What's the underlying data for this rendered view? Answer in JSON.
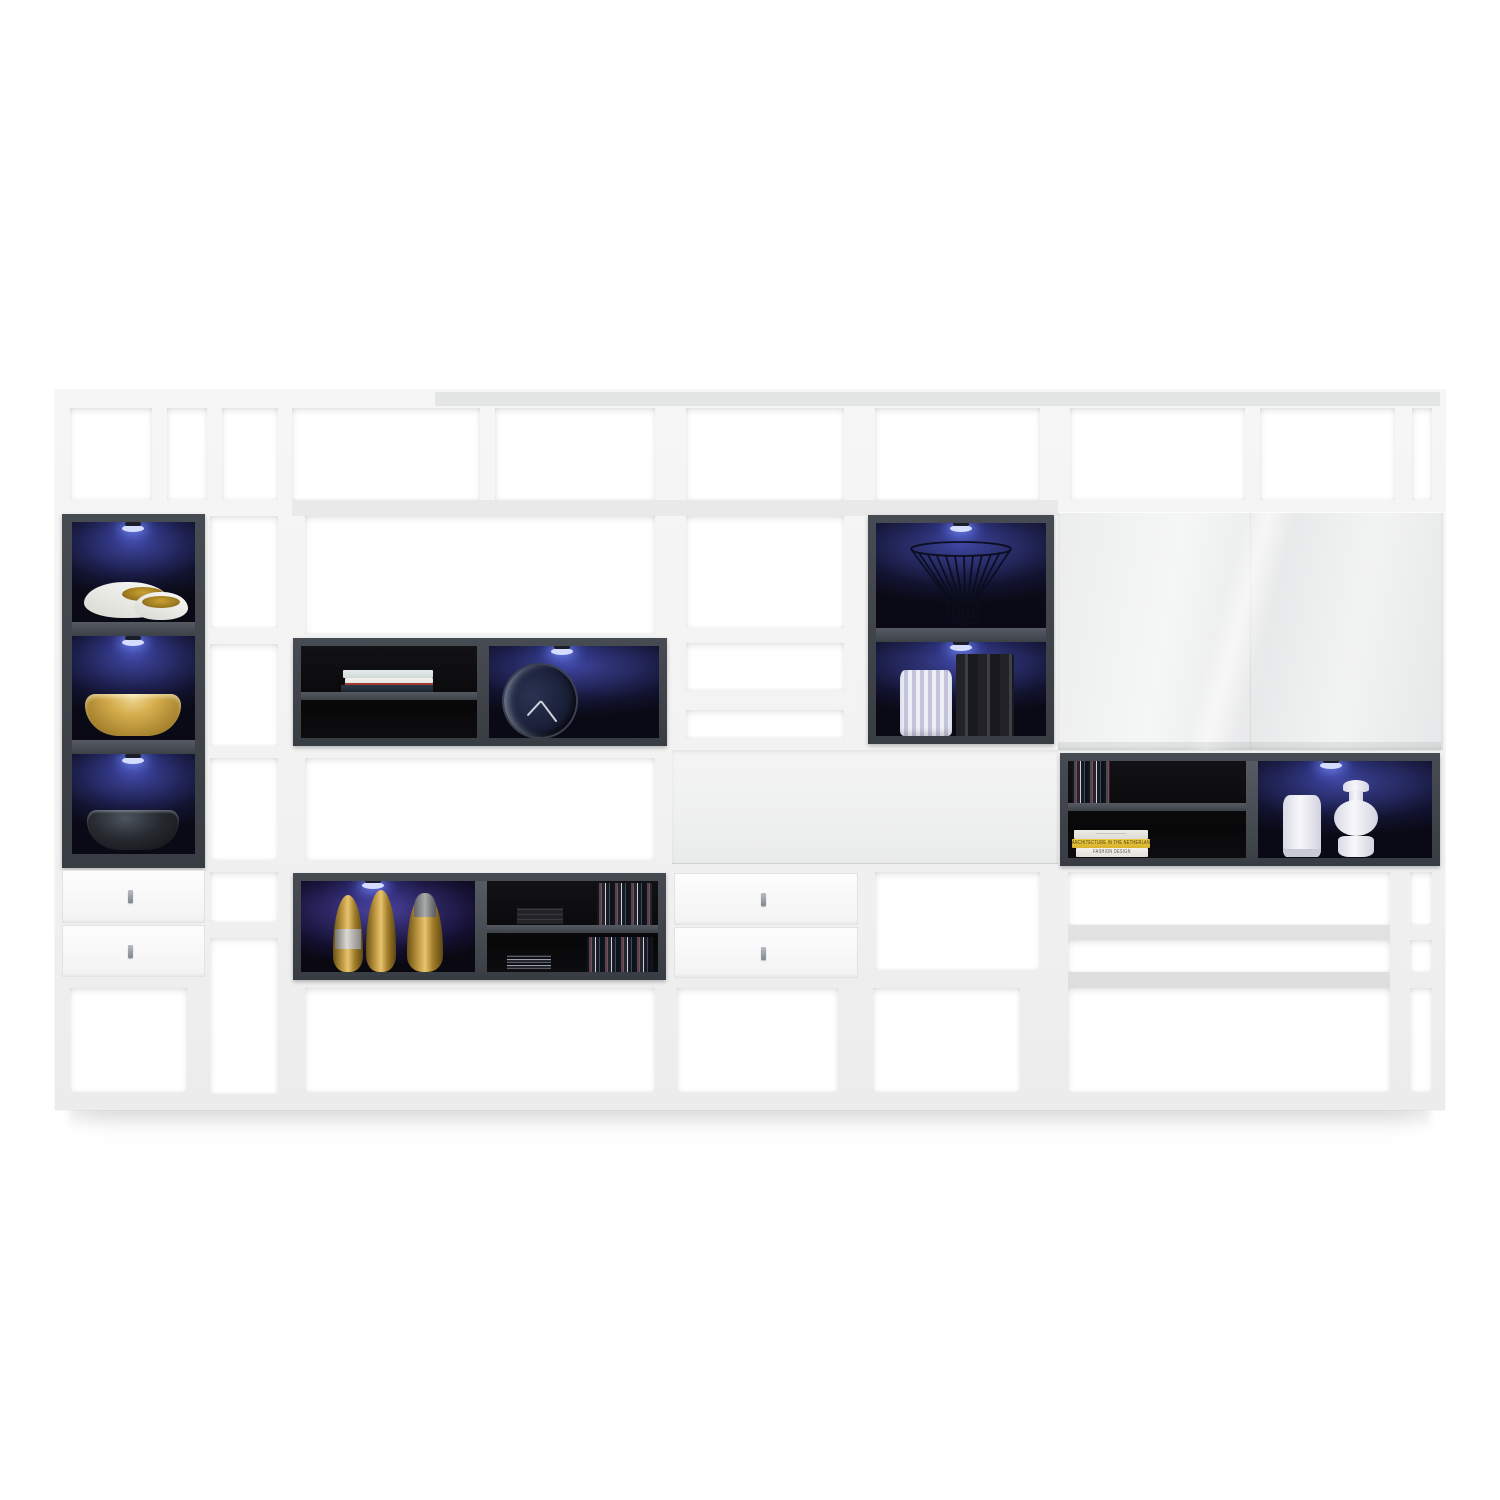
{
  "image": {
    "type": "product-photo",
    "subject": "White high-gloss living-room wall shelving unit with anthracite LED-lit display compartments, drawers and decor",
    "background_color": "#ffffff"
  },
  "palette": {
    "frame_white": "#f2f2f2",
    "open_cell": "#ffffff",
    "anthracite_frame": "#43474e",
    "black_interior": "#0a0a0d",
    "blue_led_glow": "#3c418f",
    "purple_led_glow": "#4b4198",
    "led_light": "#d4ddff",
    "gloss_panel": "#ededee",
    "gold": "#c29a42",
    "yellow_book": "#e6c23a"
  },
  "unit": {
    "left_column": {
      "display_cells": [
        {
          "item": "pair of white bowls with gold interior"
        },
        {
          "item": "gold metal bowl"
        },
        {
          "item": "anthracite bowl"
        }
      ],
      "drawer_count": 2
    },
    "center": {
      "upper_box": {
        "left": "stack of three books on shelf",
        "right": "round clock with navy face and silver rim"
      },
      "lower_box": {
        "left": "three gold bottle vases",
        "right": "CD collection on two black shelves"
      },
      "drawer_count": 2,
      "flap_panel": "wide white fold-down front"
    },
    "tall_column": {
      "upper_cell": "black wire basket",
      "lower_cell": "fluted white vase and dark books"
    },
    "right": {
      "gloss_door": "large white high-gloss sliding front",
      "display_box": {
        "left": "CDs and stacked design books",
        "right": "two white ceramic vases"
      },
      "open_shelves": true
    },
    "led_count": 8
  },
  "books": {
    "yellow_title": "ARCHITECTURE IN THE NETHERLANDS",
    "white_title": "FASHION DESIGN"
  }
}
